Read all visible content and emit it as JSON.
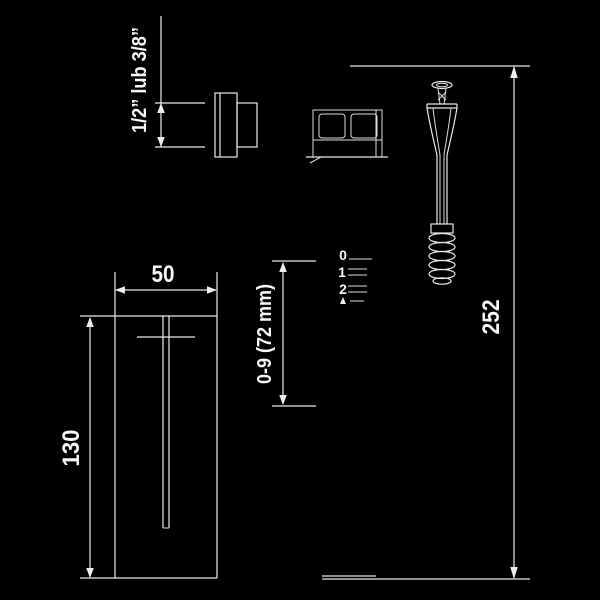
{
  "meta": {
    "background_color": "#000000",
    "line_color": "#e9e9e9",
    "text_color": "#f7f7f7"
  },
  "drawing": {
    "dimensions": {
      "inlet_thread": "1/2” lub 3/8”",
      "box_width": "50",
      "adjustment_range": "0-9 (72 mm)",
      "box_height": "130",
      "total_height": "252"
    },
    "scale_marks": [
      "0",
      "1",
      "2"
    ]
  }
}
